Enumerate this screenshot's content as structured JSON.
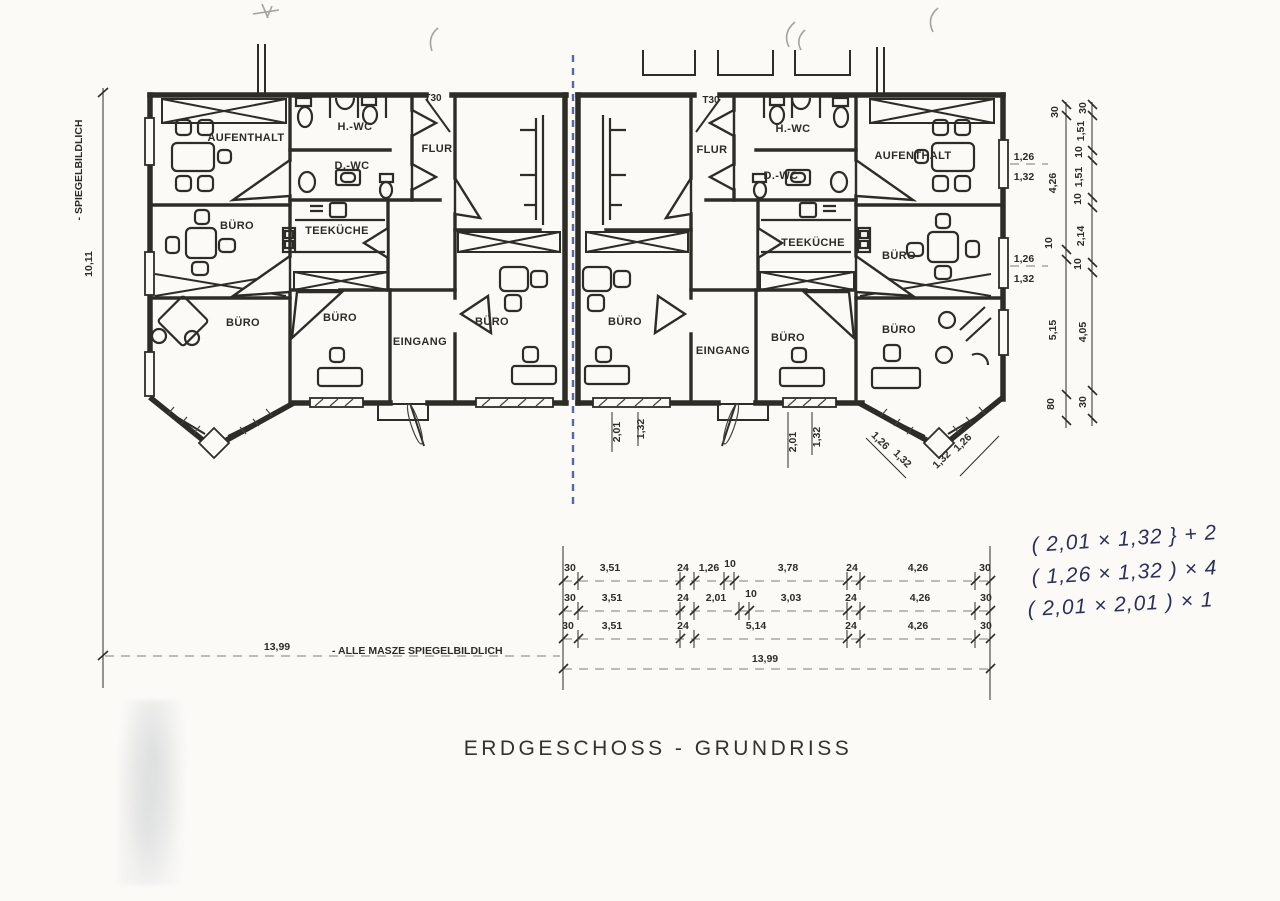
{
  "title": "ERDGESCHOSS - GRUNDRISS",
  "colors": {
    "ink": "#2e2c27",
    "blue_centerline": "#5668ab",
    "handwriting_ink": "#2a3057",
    "paper": "#fbfaf7"
  },
  "left_wing": {
    "t30": "T30",
    "aufenthalt": "AUFENTHALT",
    "h_wc": "H.-WC",
    "d_wc": "D.-WC",
    "flur": "FLUR",
    "buero_mid": "BÜRO",
    "teekueche": "TEEKÜCHE",
    "buero_sw": "BÜRO",
    "buero_s": "BÜRO",
    "buero_e": "BÜRO",
    "eingang": "EINGANG"
  },
  "right_wing": {
    "t30": "T30",
    "aufenthalt": "AUFENTHALT",
    "h_wc": "H.-WC",
    "d_wc": "D.-WC",
    "flur": "FLUR",
    "buero_mid": "BÜRO",
    "teekueche": "TEEKÜCHE",
    "buero_w": "BÜRO",
    "buero_s": "BÜRO",
    "buero_se": "BÜRO",
    "eingang": "EINGANG"
  },
  "dimensions": {
    "bottom_rows": {
      "row1": [
        "30",
        "3,51",
        "24",
        "1,26",
        "10",
        "3,78",
        "24",
        "4,26",
        "30"
      ],
      "row2": [
        "30",
        "3,51",
        "24",
        "2,01",
        "10",
        "3,03",
        "24",
        "4,26",
        "30"
      ],
      "row3": [
        "30",
        "3,51",
        "24",
        "5,14",
        "24",
        "4,26",
        "30"
      ],
      "right_total": "13,99",
      "left_total": "13,99",
      "left_note": "- ALLE MASZE SPIEGELBILDLICH"
    },
    "left_vertical": {
      "note": "- SPIEGELBILDLICH",
      "value": "10,11"
    },
    "right_vertical": {
      "inner": [
        "30",
        "4,26",
        "10",
        "5,15",
        "80"
      ],
      "outer": [
        "30",
        "1,51",
        "10",
        "1,51",
        "10",
        "2,14",
        "10",
        "4,05",
        "30"
      ]
    },
    "window_labels": {
      "right_wall_upper": [
        "1,26",
        "1,32"
      ],
      "right_wall_lower": [
        "1,26",
        "1,32"
      ],
      "bottom_window1": [
        "2,01",
        "1,32"
      ],
      "bottom_window2": [
        "2,01",
        "1,32"
      ],
      "bay_left": [
        "1,26",
        "1,32"
      ],
      "bay_right": [
        "1,26",
        "1,32"
      ]
    }
  },
  "handwritten_notes": {
    "line1": "( 2,01 × 1,32 } + 2",
    "line2": "( 1,26 × 1,32 ) × 4",
    "line3": "( 2,01 × 2,01 ) × 1"
  }
}
